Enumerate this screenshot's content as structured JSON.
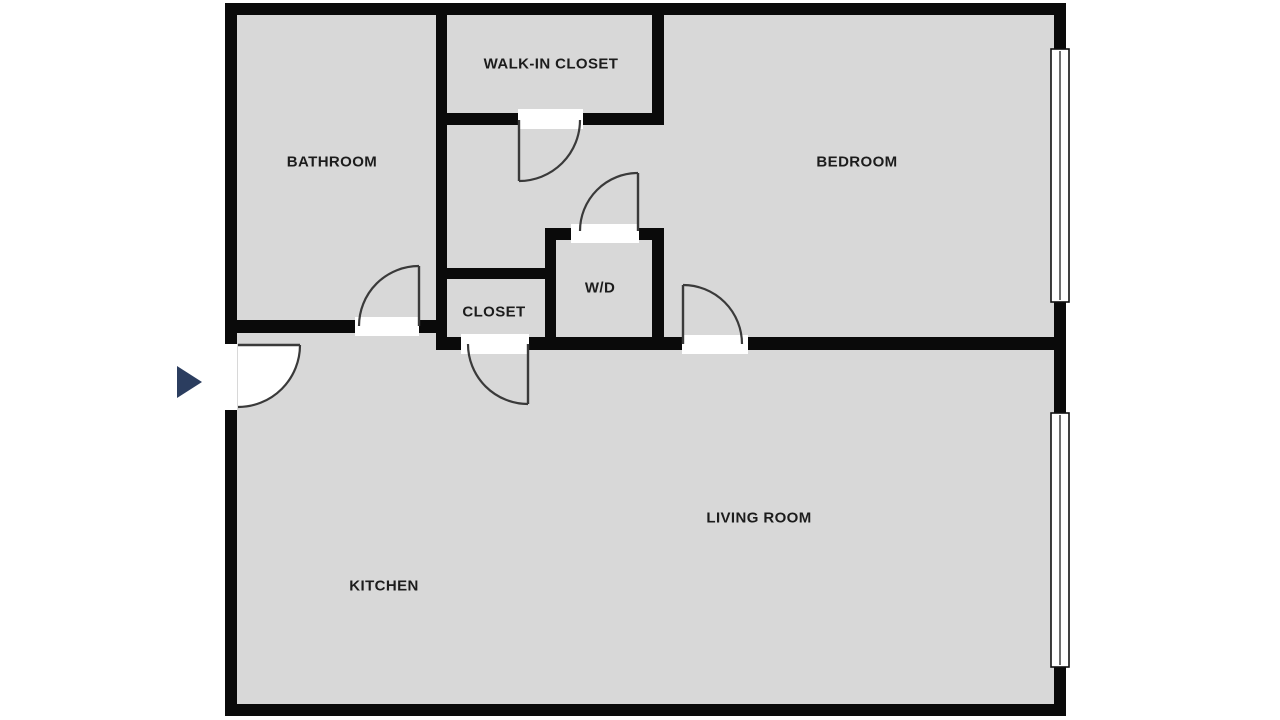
{
  "canvas": {
    "width": 1280,
    "height": 720,
    "background": "#ffffff"
  },
  "style": {
    "floor_color": "#d8d8d8",
    "wall_color": "#0a0a0a",
    "door_color": "#3a3a3a",
    "window_fill": "#ffffff",
    "window_border": "#111111",
    "label_color": "#1c1c1c",
    "entry_arrow_color": "#2b3d5f"
  },
  "rooms": [
    {
      "id": "bathroom",
      "label": "BATHROOM",
      "cx": 332,
      "cy": 162
    },
    {
      "id": "walk-in-closet",
      "label": "WALK-IN CLOSET",
      "cx": 551,
      "cy": 64
    },
    {
      "id": "bedroom",
      "label": "BEDROOM",
      "cx": 857,
      "cy": 162
    },
    {
      "id": "closet",
      "label": "CLOSET",
      "cx": 494,
      "cy": 312
    },
    {
      "id": "wd",
      "label": "W/D",
      "cx": 600,
      "cy": 288
    },
    {
      "id": "living-room",
      "label": "LIVING ROOM",
      "cx": 759,
      "cy": 518
    },
    {
      "id": "kitchen",
      "label": "KITCHEN",
      "cx": 384,
      "cy": 586
    }
  ],
  "floor": {
    "x": 237,
    "y": 15,
    "w": 817,
    "h": 689
  },
  "walls": [
    {
      "name": "outer-top-wall",
      "x": 225,
      "y": 3,
      "w": 841,
      "h": 12
    },
    {
      "name": "outer-bottom-wall",
      "x": 225,
      "y": 704,
      "w": 841,
      "h": 12
    },
    {
      "name": "outer-left-wall-upper",
      "x": 225,
      "y": 3,
      "w": 12,
      "h": 341
    },
    {
      "name": "outer-left-wall-lower",
      "x": 225,
      "y": 410,
      "w": 12,
      "h": 306
    },
    {
      "name": "outer-right-wall",
      "x": 1054,
      "y": 3,
      "w": 12,
      "h": 713
    },
    {
      "name": "bathroom-hall-divider",
      "x": 436,
      "y": 15,
      "w": 11,
      "h": 335
    },
    {
      "name": "bathroom-bottom-wall",
      "x": 237,
      "y": 320,
      "w": 210,
      "h": 13
    },
    {
      "name": "walkin-closet-bottom",
      "x": 436,
      "y": 113,
      "w": 228,
      "h": 12
    },
    {
      "name": "walkin-closet-right",
      "x": 652,
      "y": 15,
      "w": 12,
      "h": 110
    },
    {
      "name": "closet-top-wall",
      "x": 436,
      "y": 268,
      "w": 120,
      "h": 11
    },
    {
      "name": "closet-wd-divider",
      "x": 545,
      "y": 228,
      "w": 11,
      "h": 122
    },
    {
      "name": "wd-top-wall",
      "x": 545,
      "y": 228,
      "w": 119,
      "h": 12
    },
    {
      "name": "wd-right-wall",
      "x": 652,
      "y": 228,
      "w": 12,
      "h": 122
    },
    {
      "name": "main-horizontal-wall",
      "x": 436,
      "y": 337,
      "w": 618,
      "h": 13
    }
  ],
  "door_openings": [
    {
      "name": "bathroom-door-opening",
      "x": 355,
      "y": 317,
      "w": 64,
      "h": 19
    },
    {
      "name": "walkin-closet-door-opening",
      "x": 518,
      "y": 109,
      "w": 65,
      "h": 20
    },
    {
      "name": "wd-door-opening",
      "x": 571,
      "y": 224,
      "w": 68,
      "h": 19
    },
    {
      "name": "closet-door-opening",
      "x": 461,
      "y": 334,
      "w": 68,
      "h": 20
    },
    {
      "name": "bedroom-door-opening",
      "x": 682,
      "y": 335,
      "w": 66,
      "h": 19
    }
  ],
  "doors": [
    {
      "name": "entry-door",
      "hx": 238,
      "hy": 345,
      "r": 62,
      "open_deg": 0,
      "closed_deg": 90,
      "sweep": 1,
      "wedge": "#ffffff"
    },
    {
      "name": "bathroom-door",
      "hx": 419,
      "hy": 326,
      "r": 60,
      "open_deg": -90,
      "closed_deg": 180,
      "sweep": 0,
      "wedge": null
    },
    {
      "name": "walkin-closet-door",
      "hx": 519,
      "hy": 120,
      "r": 61,
      "open_deg": 90,
      "closed_deg": 0,
      "sweep": 0,
      "wedge": null
    },
    {
      "name": "wd-door",
      "hx": 638,
      "hy": 231,
      "r": 58,
      "open_deg": -90,
      "closed_deg": 180,
      "sweep": 0,
      "wedge": null
    },
    {
      "name": "closet-door",
      "hx": 528,
      "hy": 344,
      "r": 60,
      "open_deg": 90,
      "closed_deg": 180,
      "sweep": 1,
      "wedge": null
    },
    {
      "name": "bedroom-door",
      "hx": 683,
      "hy": 344,
      "r": 59,
      "open_deg": -90,
      "closed_deg": 0,
      "sweep": 1,
      "wedge": null
    }
  ],
  "windows": [
    {
      "name": "bedroom-window",
      "x": 1051,
      "y": 49,
      "w": 18,
      "h": 253
    },
    {
      "name": "living-room-window",
      "x": 1051,
      "y": 413,
      "w": 18,
      "h": 254
    }
  ],
  "entry_arrow": {
    "points": [
      [
        177,
        366
      ],
      [
        177,
        398
      ],
      [
        202,
        382
      ]
    ]
  }
}
